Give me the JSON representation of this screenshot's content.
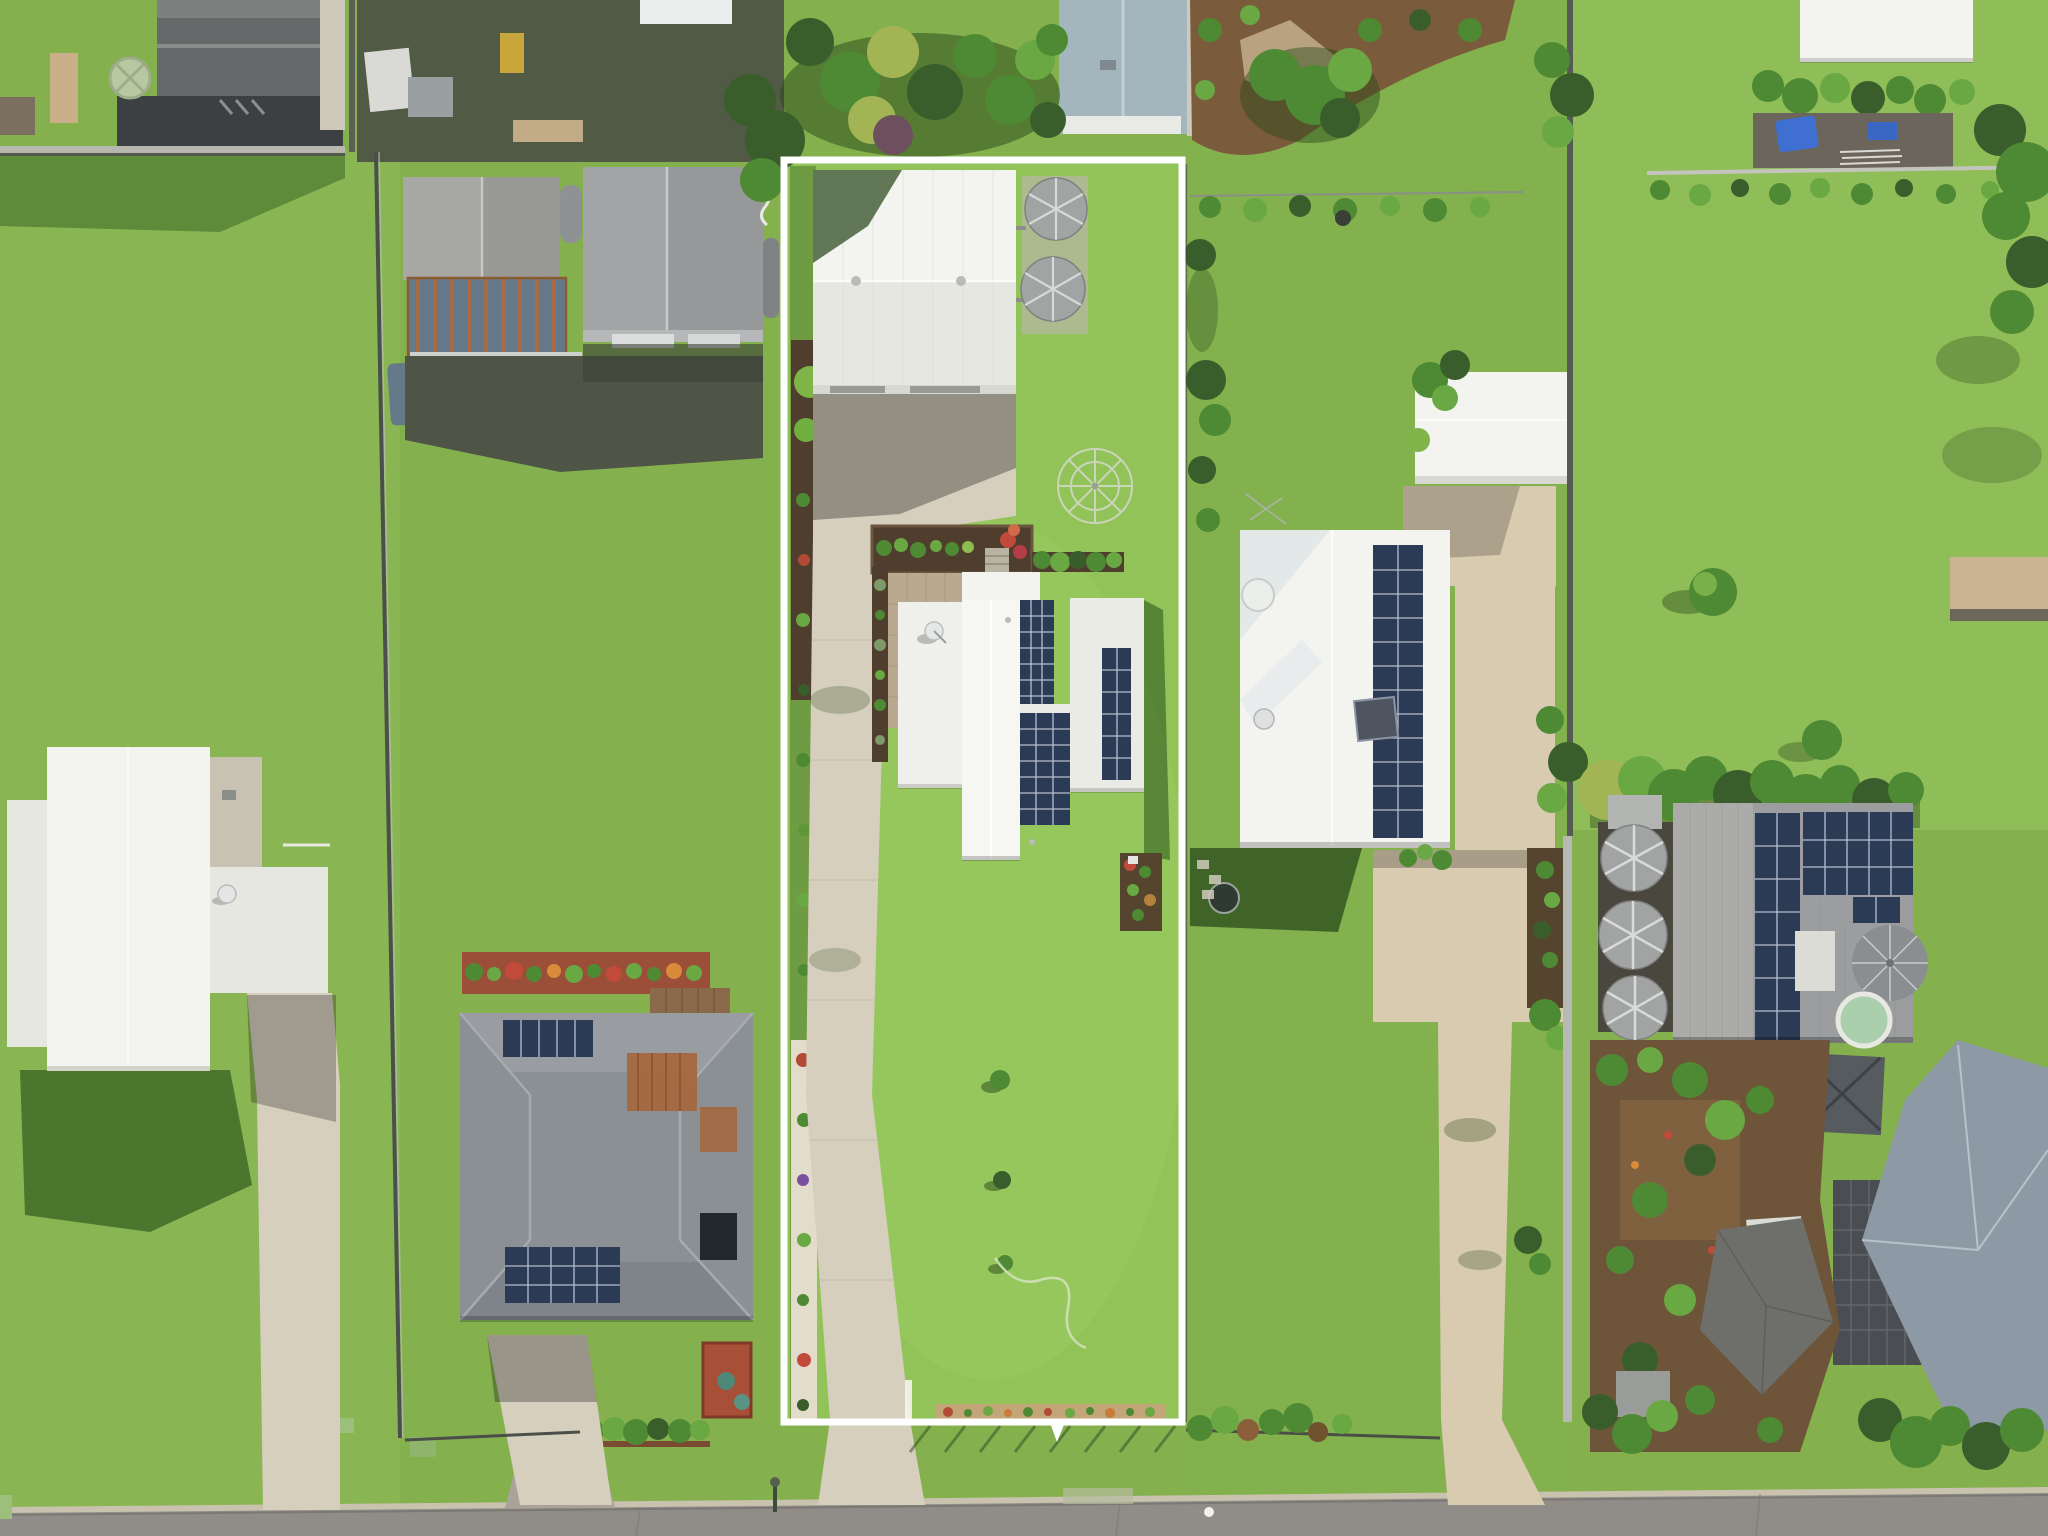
{
  "image": {
    "type": "aerial-drone-photograph",
    "subject": "residential allotment outlined in white, viewed top-down",
    "orientation": "top-down, street at bottom, sun from north-east"
  },
  "annotation": {
    "kind": "property-boundary-outline",
    "shape": "rectangle",
    "color": "#ffffff",
    "stroke_width_px": 7
  },
  "scene": {
    "subject_lot_features": [
      "large white shed",
      "two round water tanks",
      "white-roof house with solar panels",
      "satellite dish",
      "long concrete driveway",
      "raised garden beds",
      "rotary clothesline",
      "large rear lawn",
      "garden hose",
      "front fence with garden bed"
    ],
    "neighbours_left": [
      "grey garage shed with pergola",
      "white ute",
      "grey-roof house with solar panels",
      "flower garden bed",
      "white-roof house with satellite dish"
    ],
    "neighbours_right": [
      "white-roof house with solar array",
      "long beige driveway",
      "white shed with palms",
      "trampoline",
      "solar-roof house with three water tanks",
      "two cream water tanks",
      "grey umbrella",
      "caravan under shade sail",
      "blue-grey tiled roof house",
      "green pool"
    ],
    "street": [
      "asphalt road",
      "concrete kerb",
      "street light",
      "green utility boxes",
      "driveway aprons"
    ]
  },
  "palette": {
    "lawn": "#84b14e",
    "lawn-bright": "#92c358",
    "lawn-pale": "#9cc167",
    "lawn-dark": "#6f9c40",
    "tree-dark": "#3a5e2b",
    "tree-mid": "#4e8a33",
    "tree-light": "#6aa844",
    "tree-yellow": "#a3b455",
    "concrete": "#d6cfbe",
    "concrete-warm": "#d8cbaf",
    "concrete-shadow": "#98948a",
    "road": "#908c87",
    "kerb": "#c9c2ae",
    "roof-white": "#f3f3f0",
    "roof-white-shade": "#e7e7e2",
    "roof-gray": "#9b9d9e",
    "roof-gray-dark": "#85878a",
    "roof-slate": "#8b9095",
    "roof-bluegray": "#a3b6be",
    "roof-blue-house": "#8d99a4",
    "roof-dark": "#66686a",
    "carport-dark": "#3c4042",
    "panel": "#2b3a55",
    "panel-line": "#cfd6e0",
    "mulch": "#4f3e2d",
    "mulch-red": "#9c4f38",
    "mulch-brown": "#6e5438",
    "gravel": "#e3dccb",
    "tan-paver": "#b9a98e",
    "tank-gray": "#a2a4a3",
    "tank-cream": "#ece5d4",
    "rust": "#b06a3a",
    "boundary": "#ffffff",
    "blue-tarp": "#3f6fd1",
    "teal": "#4f8878",
    "sail": "#6e6f6b",
    "umbrella": "#8b8e90",
    "canopy-blue": "#66798a",
    "deck-brown": "#8a6a4a",
    "bed-tan": "#c2a678"
  }
}
